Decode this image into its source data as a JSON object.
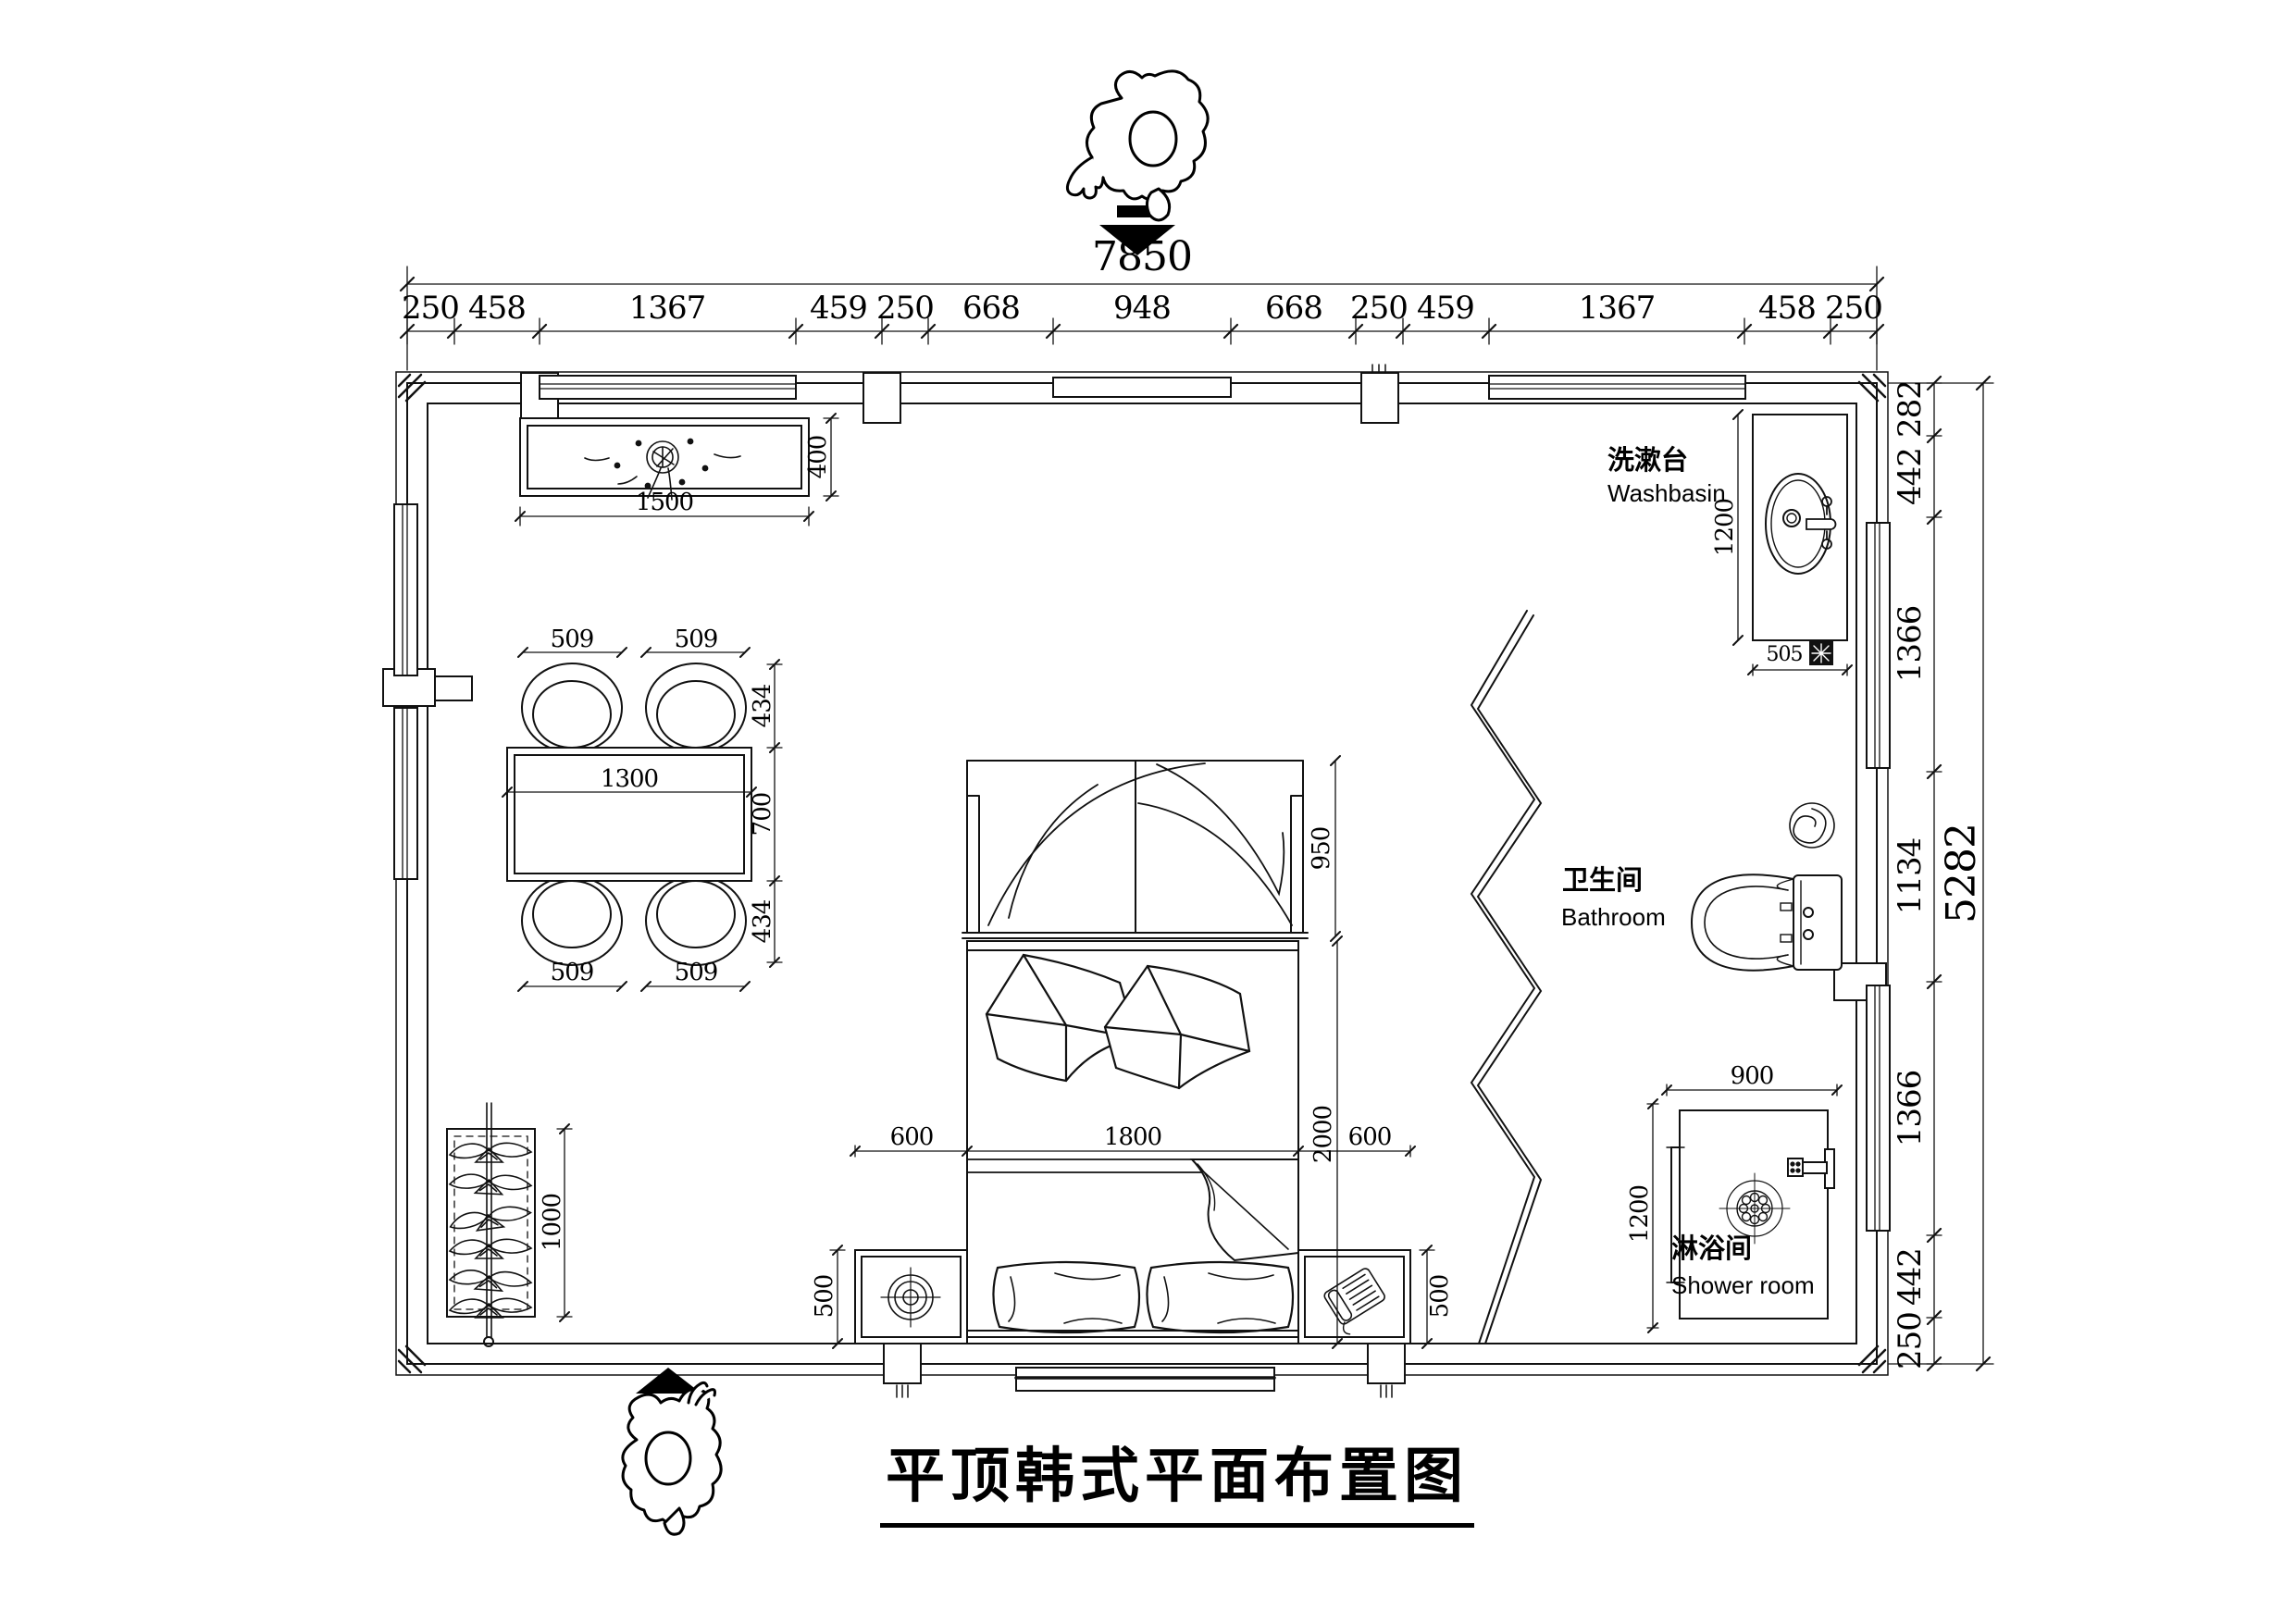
{
  "title": {
    "text": "平顶韩式平面布置图"
  },
  "rooms": {
    "washbasin": {
      "zh": "洗漱台",
      "en": "Washbasin"
    },
    "bathroom": {
      "zh": "卫生间",
      "en": "Bathroom"
    },
    "shower": {
      "zh": "淋浴间",
      "en": "Shower room"
    }
  },
  "dims": {
    "top_total": "7850",
    "top_segments": [
      "250",
      "458",
      "1367",
      "459",
      "250",
      "668",
      "948",
      "668",
      "250",
      "459",
      "1367",
      "458",
      "250"
    ],
    "right_total": "5282",
    "right_segments": [
      "282",
      "442",
      "1366",
      "1134",
      "1366",
      "442",
      "250"
    ],
    "tv_width": "1500",
    "tv_depth": "400",
    "table_width": "1300",
    "table_depth": "700",
    "chair_tl": "509",
    "chair_tr": "509",
    "chair_bl": "509",
    "chair_br": "509",
    "chair_depth_top": "434",
    "chair_depth_bottom": "434",
    "wardrobe_height": "1000",
    "bed_head": "950",
    "bed_width": "1800",
    "bed_length": "2000",
    "bed_gap_left": "600",
    "bed_gap_right": "600",
    "nightstand_left": "500",
    "nightstand_right": "500",
    "basin_length": "1200",
    "basin_width": "505",
    "shower_width": "900",
    "shower_depth": "1200"
  },
  "colors": {
    "line": "#111111",
    "background": "#ffffff"
  }
}
